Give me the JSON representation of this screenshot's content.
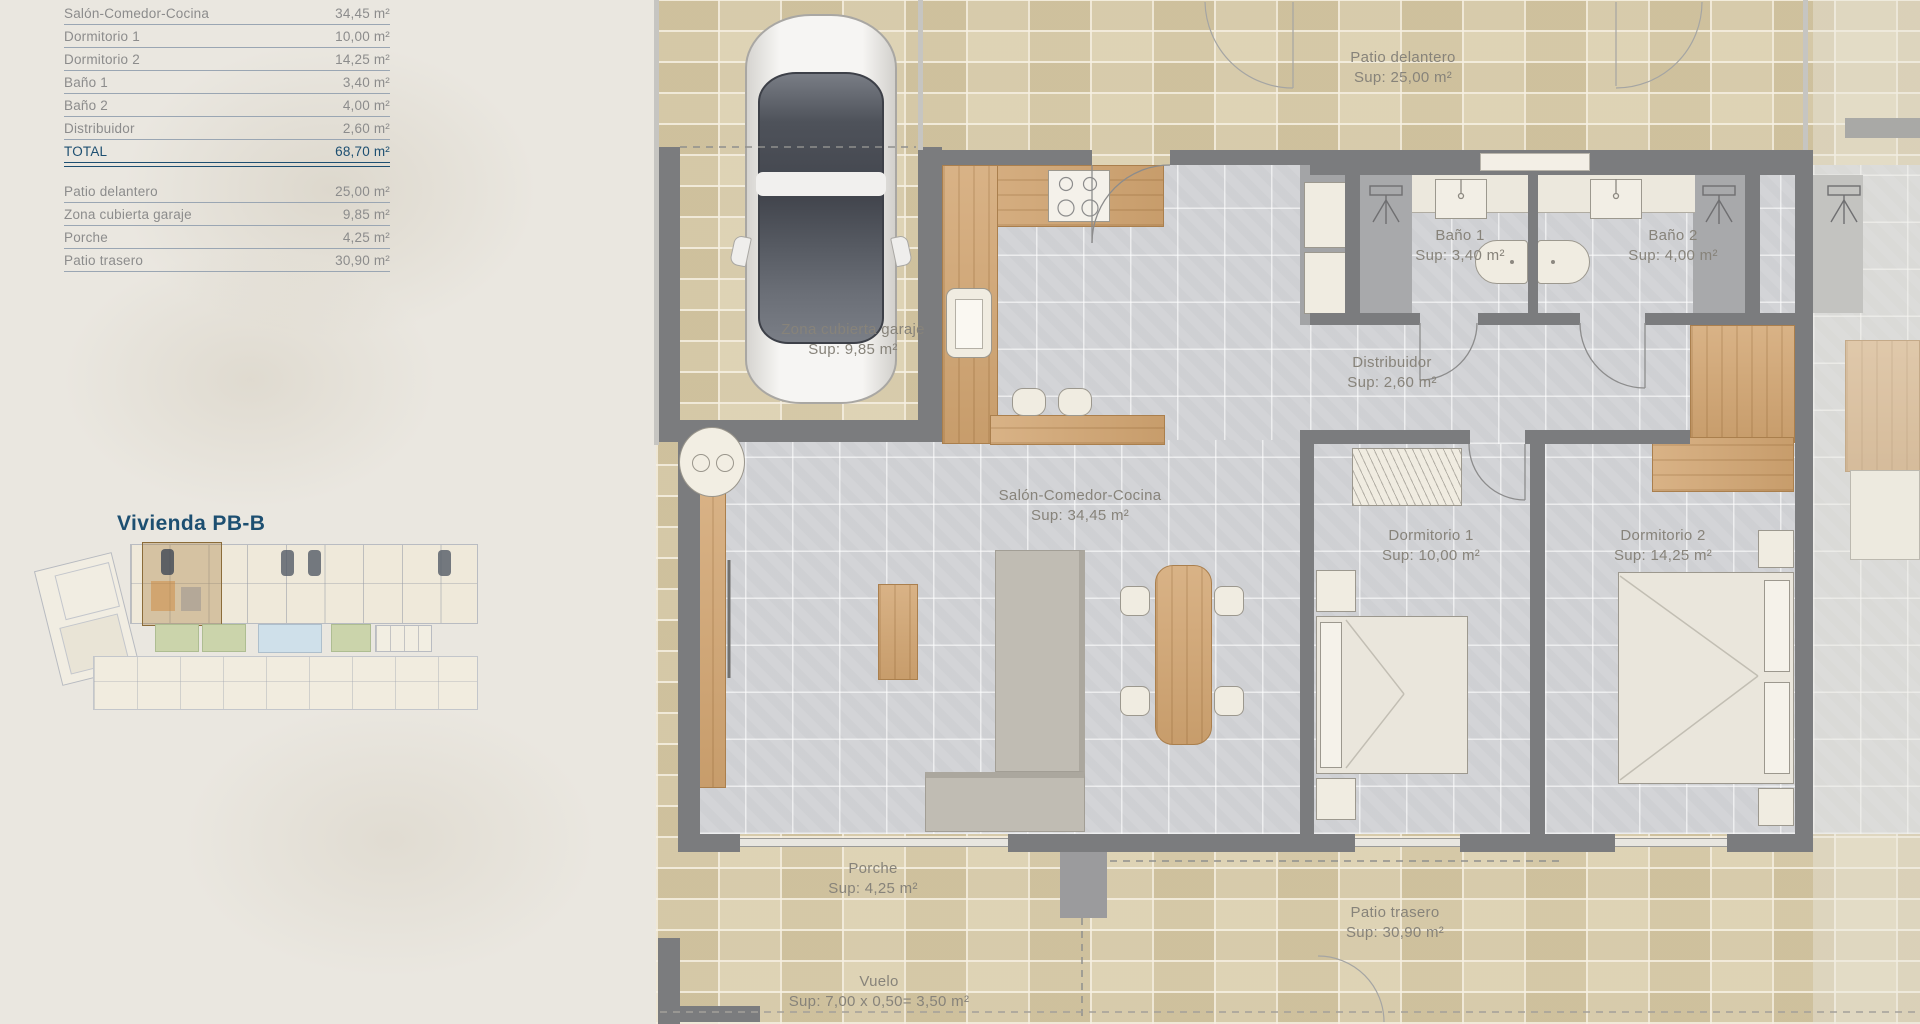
{
  "panel": {
    "title": "Vivienda PB-B",
    "interior": {
      "rows": [
        {
          "label": "Salón-Comedor-Cocina",
          "value": "34,45 m²"
        },
        {
          "label": "Dormitorio 1",
          "value": "10,00 m²"
        },
        {
          "label": "Dormitorio 2",
          "value": "14,25 m²"
        },
        {
          "label": "Baño 1",
          "value": "3,40 m²"
        },
        {
          "label": "Baño 2",
          "value": "4,00 m²"
        },
        {
          "label": "Distribuidor",
          "value": "2,60 m²"
        }
      ],
      "total": {
        "label": "TOTAL",
        "value": "68,70 m²"
      }
    },
    "exterior": {
      "rows": [
        {
          "label": "Patio delantero",
          "value": "25,00 m²"
        },
        {
          "label": "Zona cubierta garaje",
          "value": "9,85 m²"
        },
        {
          "label": "Porche",
          "value": "4,25 m²"
        },
        {
          "label": "Patio trasero",
          "value": "30,90 m²"
        }
      ]
    }
  },
  "plan": {
    "rooms": {
      "patio_delantero": {
        "name": "Patio delantero",
        "sup": "Sup: 25,00 m²"
      },
      "zona_garaje": {
        "name": "Zona cubierta garaje",
        "sup": "Sup: 9,85 m²"
      },
      "bano1": {
        "name": "Baño 1",
        "sup": "Sup: 3,40 m²"
      },
      "bano2": {
        "name": "Baño 2",
        "sup": "Sup: 4,00 m²"
      },
      "distribuidor": {
        "name": "Distribuidor",
        "sup": "Sup: 2,60 m²"
      },
      "salon": {
        "name": "Salón-Comedor-Cocina",
        "sup": "Sup: 34,45 m²"
      },
      "dorm1": {
        "name": "Dormitorio 1",
        "sup": "Sup: 10,00 m²"
      },
      "dorm2": {
        "name": "Dormitorio 2",
        "sup": "Sup: 14,25 m²"
      },
      "porche": {
        "name": "Porche",
        "sup": "Sup: 4,25 m²"
      },
      "patio_trasero": {
        "name": "Patio trasero",
        "sup": "Sup: 30,90 m²"
      },
      "vuelo": {
        "name": "Vuelo",
        "sup": "Sup: 7,00 x 0,50= 3,50 m²"
      }
    }
  },
  "colors": {
    "accent_navy": "#1d4f71",
    "table_text_gray": "#8c8c8c",
    "plan_label_gray": "#87837a",
    "wall_gray": "#7b7c7e",
    "wood": "#d2a571",
    "tile_beige": "#d9cdab",
    "tile_gray": "#d3d4d7",
    "pool_blue": "#cfe0ea",
    "garden_green": "#cbd4ab",
    "highlight_unit": "#a67c3b"
  }
}
